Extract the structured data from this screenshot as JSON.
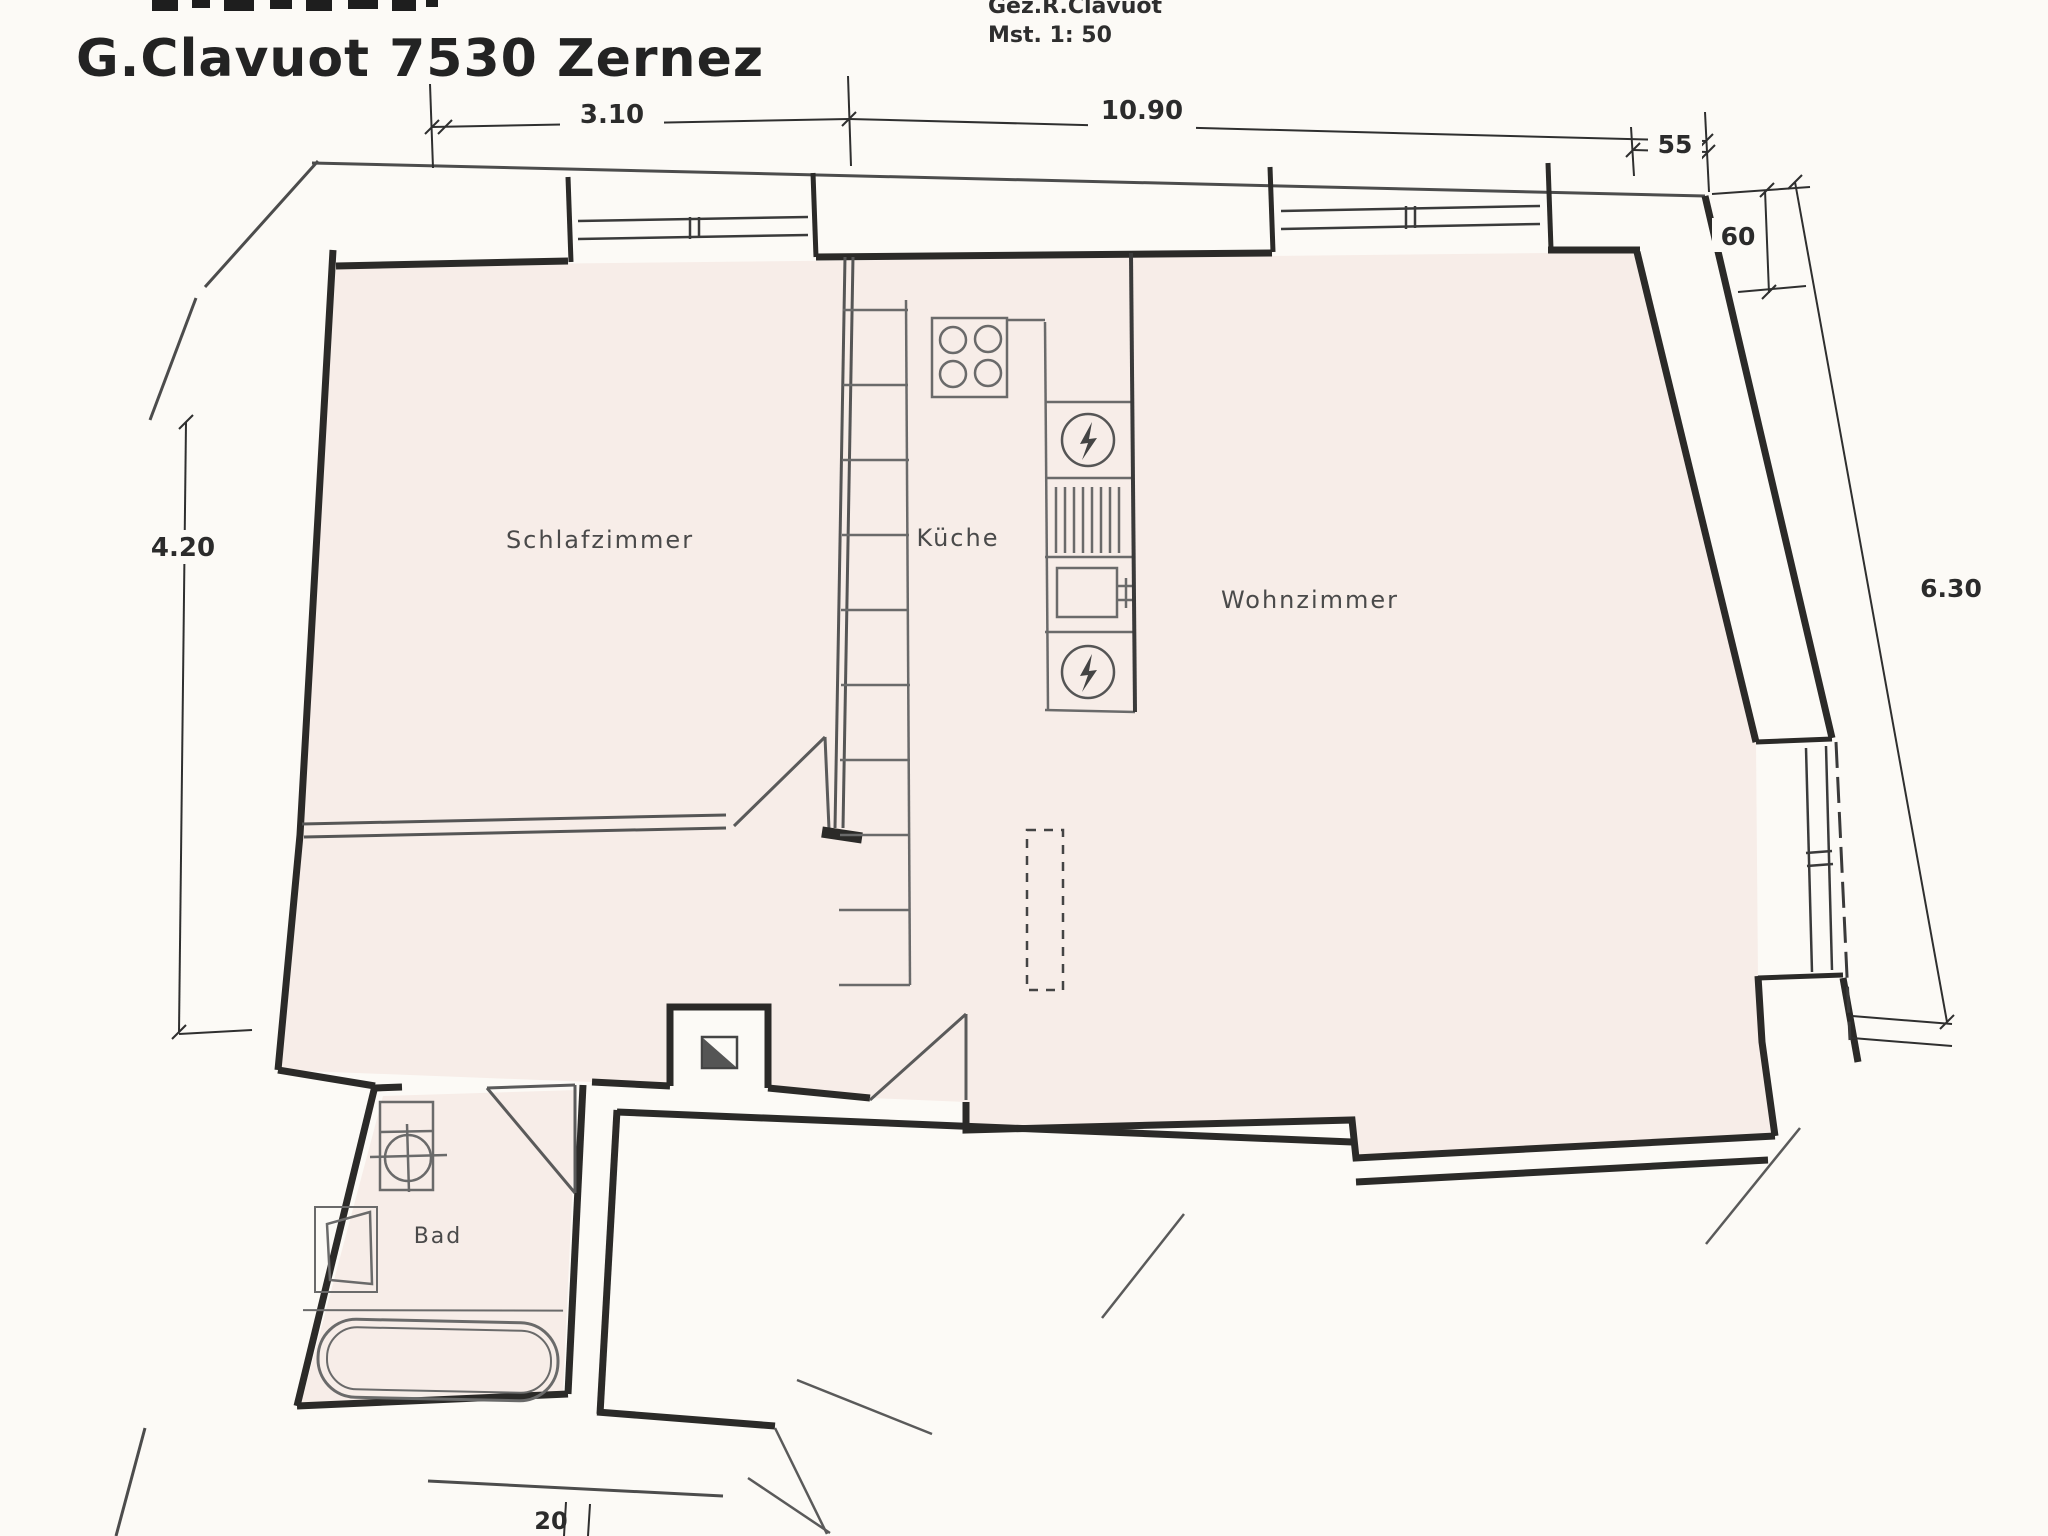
{
  "header": {
    "title": "G.Clavuot 7530 Zernez",
    "drawn_by": "Gez.R.Clavuot",
    "scale_note": "Mst. 1: 50"
  },
  "rooms": {
    "bedroom": "Schlafzimmer",
    "kitchen": "Küche",
    "living": "Wohnzimmer",
    "bath": "Bad"
  },
  "dimensions": {
    "bedroom_width": "3.10",
    "total_width": "10.90",
    "wall_top_right": "55",
    "wall_right_depth": "60",
    "left_height": "4.20",
    "right_height": "6.30",
    "bottom_wall": "20"
  },
  "icons": [
    "stove-burners-icon",
    "boiler-lightning-icon",
    "radiator-hatch-icon",
    "sink-icon",
    "chimney-icon",
    "toilet-icon",
    "washbasin-icon",
    "bathtub-icon",
    "window-icon",
    "door-swing-icon",
    "pillar-dashed-icon",
    "break-mark-icon"
  ],
  "colors": {
    "paper": "#fcfaf6",
    "floor": "#f7ede8",
    "wall": "#2b2a28",
    "fixture": "#6a6a6a"
  }
}
